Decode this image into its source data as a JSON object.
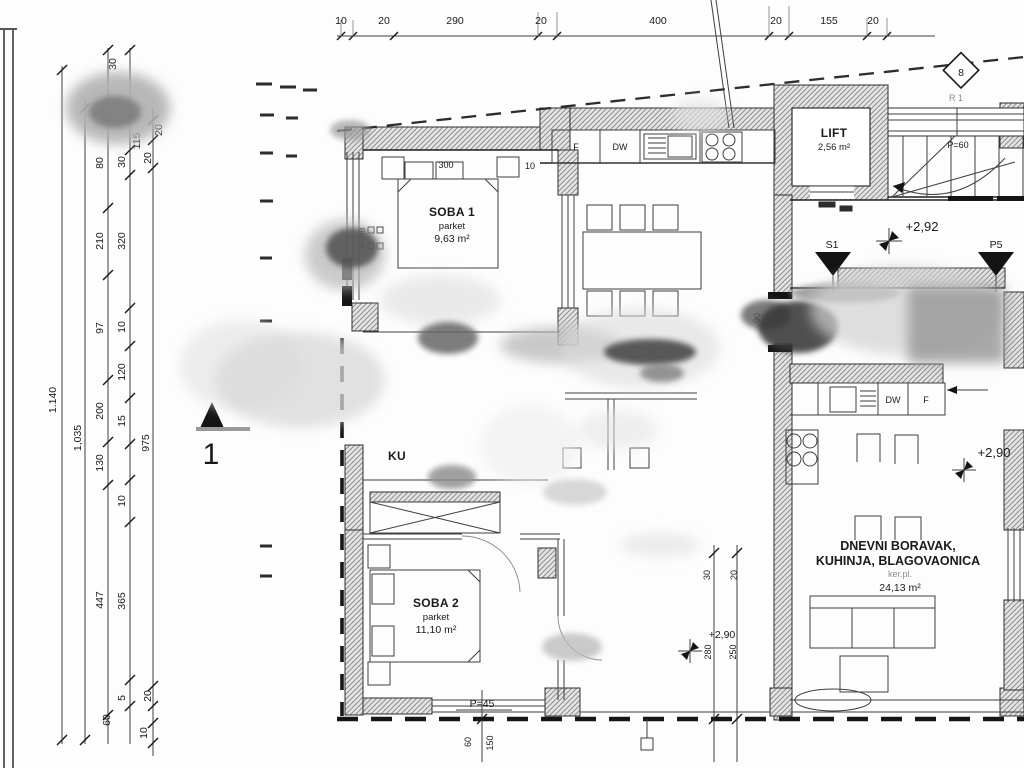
{
  "dims": {
    "top": [
      "10",
      "20",
      "290",
      "20",
      "400",
      "20",
      "155",
      "20"
    ],
    "left": [
      "1.140",
      "1,035",
      "30",
      "80",
      "115",
      "30",
      "20",
      "20",
      "210",
      "320",
      "97",
      "10",
      "120",
      "200",
      "15",
      "975",
      "130",
      "10",
      "447",
      "365",
      "60",
      "5",
      "20",
      "10"
    ],
    "plan": {
      "d300": "300",
      "d10": "10",
      "d90": "90",
      "d30": "30",
      "d20": "20",
      "d280": "280",
      "d250": "250",
      "d60": "60",
      "d150": "150"
    }
  },
  "rooms": {
    "soba1": {
      "name": "SOBA 1",
      "floor": "parket",
      "area": "9,63 m²"
    },
    "soba2": {
      "name": "SOBA 2",
      "floor": "parket",
      "area": "11,10 m²"
    },
    "lift": {
      "name": "LIFT",
      "area": "2,56 m²"
    },
    "living": {
      "line1": "DNEVNI BORAVAK,",
      "line2": "KUHINJA, BLAGOVAONICA",
      "floor": "ker.pl.",
      "area": "24,13 m²"
    },
    "bath_fragment": "KU"
  },
  "elevations": {
    "hall": "+2,92",
    "kitchen": "+2,90",
    "room": "+2,90"
  },
  "markers": {
    "section": "1",
    "diamond": "8",
    "s1": "S1",
    "p5": "P5",
    "r": "R 1"
  },
  "labels": {
    "p88": "P=88",
    "p45": "P=45",
    "p60": "P=60"
  },
  "appliances": {
    "f1": "F",
    "dw1": "DW",
    "dw2": "DW",
    "f2": "F"
  },
  "colors": {
    "line": "#3f3f3f",
    "wall_hatch": "#8f8f8f",
    "ink": "#1a1a1a",
    "smudge": "#9a9a9a"
  }
}
